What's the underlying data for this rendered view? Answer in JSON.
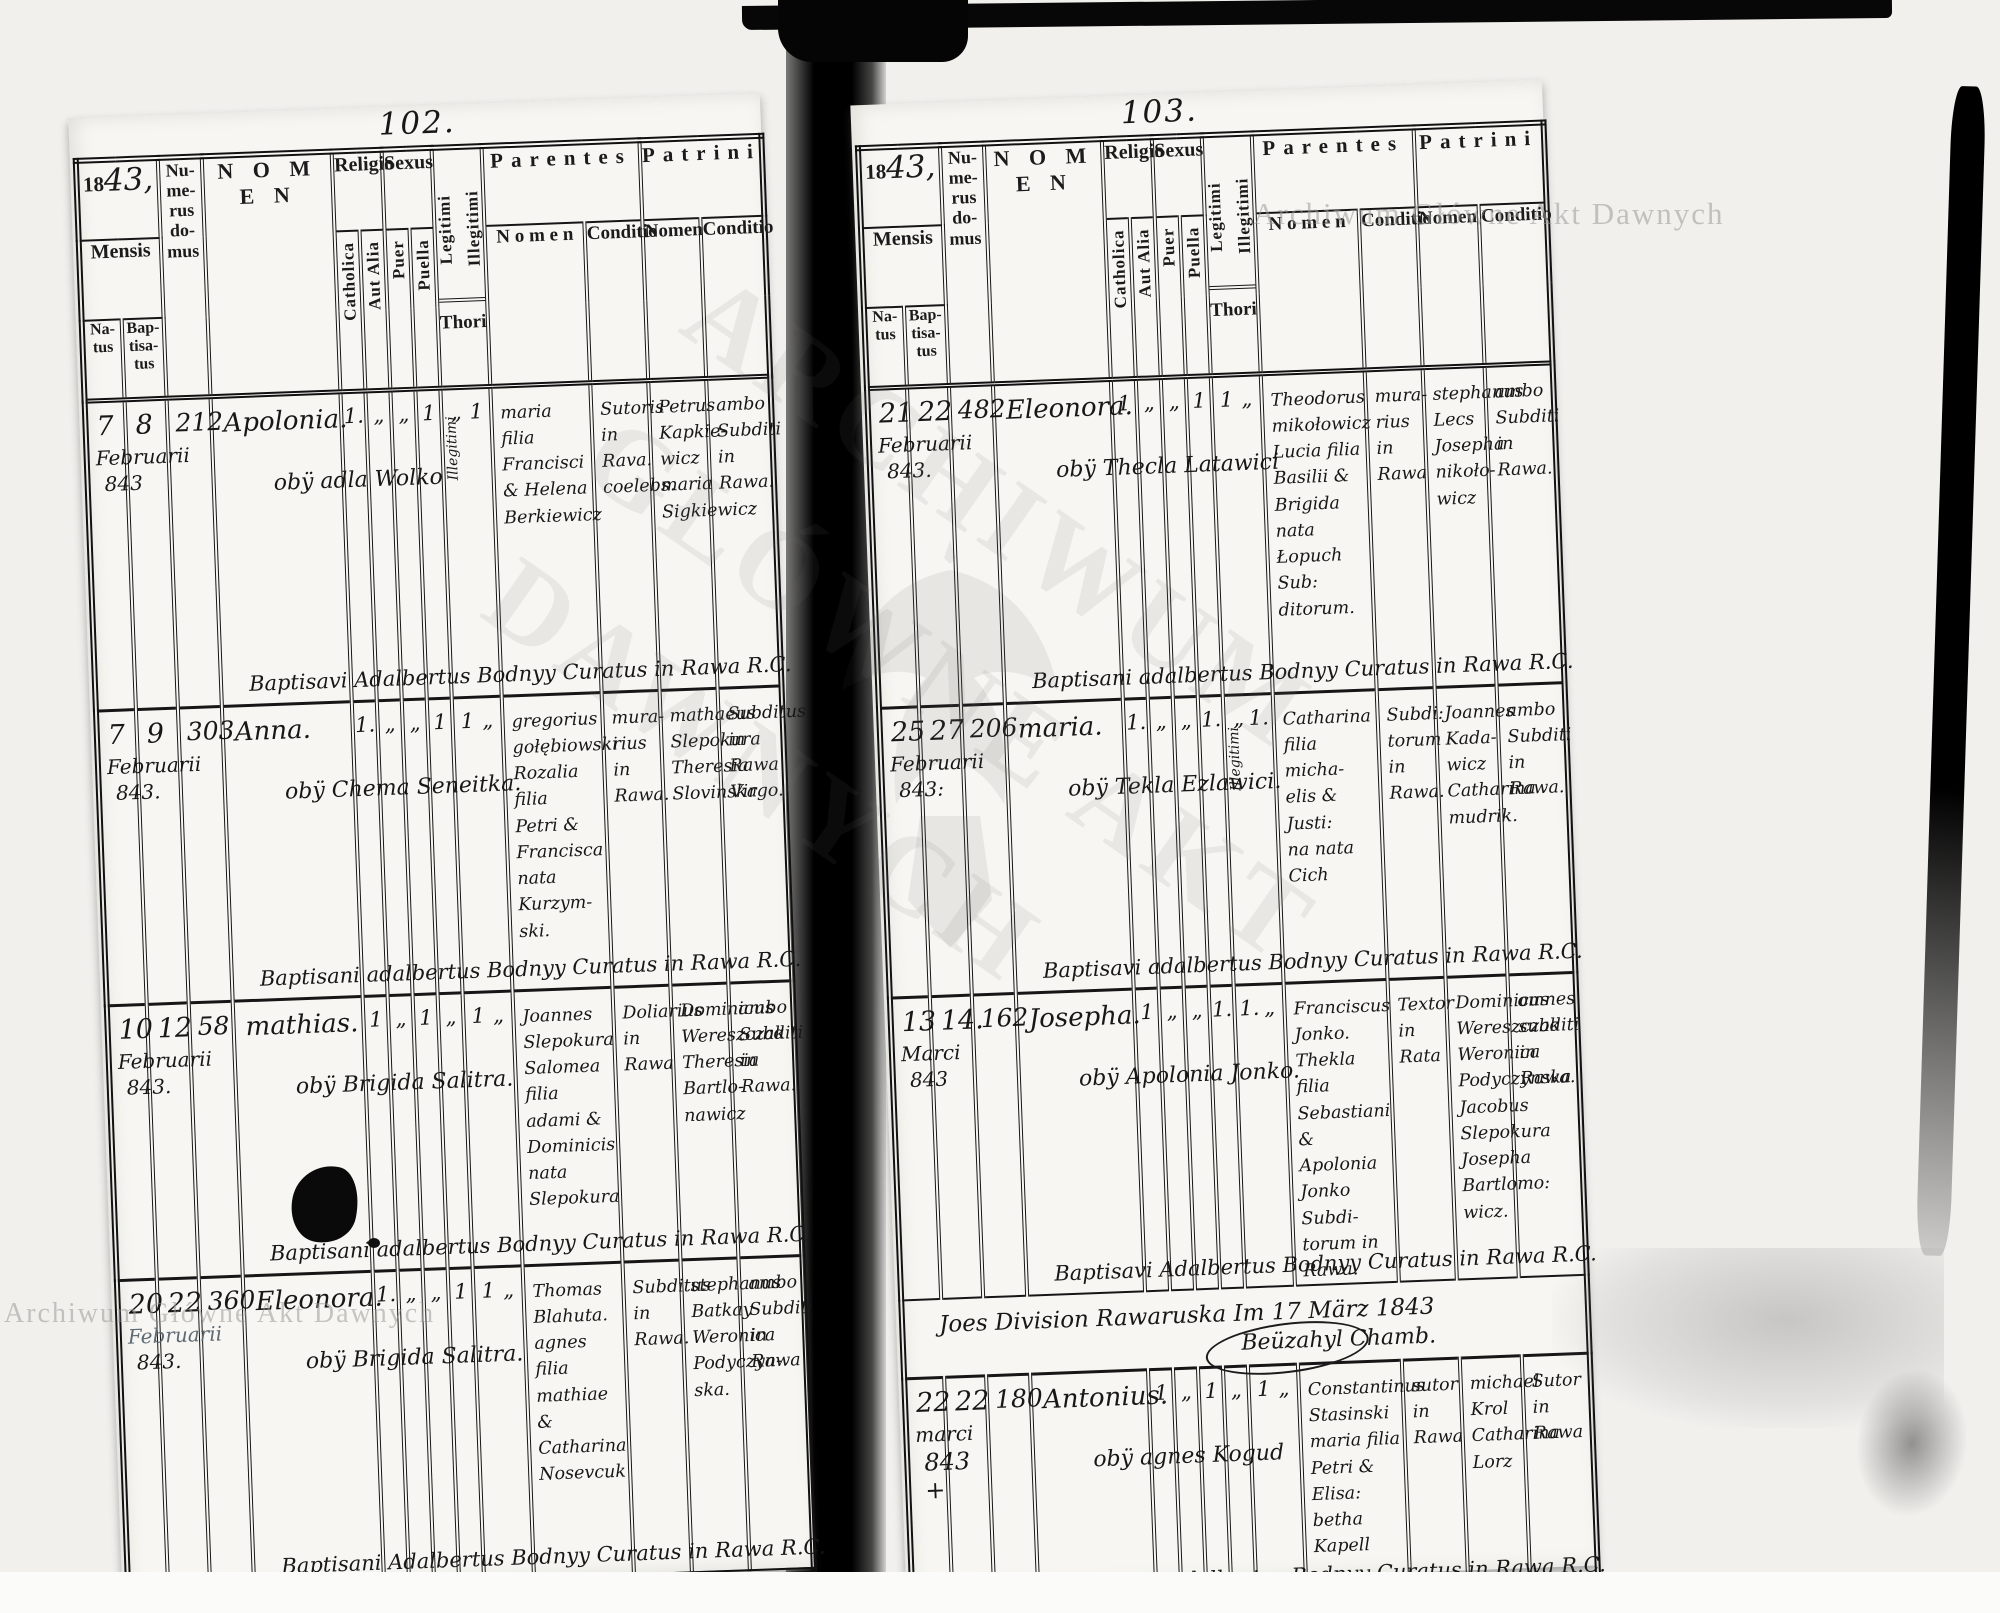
{
  "header": {
    "year_prefix": "18",
    "year_script": "43,",
    "mensis": "Mensis",
    "natus": "Na-\ntus",
    "baptisatus": "Bap-\ntisa-\ntus",
    "numerus": "Nu-\nme-\nrus\ndo-\nmus",
    "nomen": "N O M E N",
    "religio": "Religio",
    "catholica": "Catholica",
    "aut_alia": "Aut Alia",
    "sexus": "Sexus",
    "puer": "Puer",
    "puella": "Puella",
    "legitimi": "Legitimi",
    "illegitimi": "Illegitimi",
    "thori": "Thori",
    "parentes": "Parentes",
    "patrini": "Patrini",
    "parentes_nomen": "N o m e n",
    "parentes_conditio": "Conditio",
    "patrini_nomen": "Nomen",
    "patrini_conditio": "Conditio"
  },
  "watermark": {
    "text": "Archiwum Główne Akt Dawnych",
    "big": "ARCHIWUM\nGŁÓWNE AKT\nDAWNYCH"
  },
  "left_page": {
    "page_number": "102.",
    "entries": [
      {
        "natus_day": "7",
        "baptisatus_day": "8",
        "month": "Februarii",
        "year": "843",
        "house": "212",
        "name": "Apolonia.",
        "name_note": "obÿ adla Wolko",
        "catholica": "1.",
        "aut_alia": "„",
        "puer": "„",
        "puella": "1",
        "legitimi": "„",
        "illegitimi": "1",
        "thori_note": "Illegitimi",
        "parentes_nomen": "maria filia\nFrancisci\n& Helena\nBerkiewicz",
        "parentes_conditio": "Sutoris\nin\nRava.\ncoelebs.",
        "patrini_nomen": "Petrus\nKapkie-\nwicz\nmaria\nSigkiewicz",
        "patrini_conditio": "ambo\nSubditi\nin\nRawa.",
        "baptism_note": "Baptisavi Adalbertus Bodnyy Curatus in Rawa R.C."
      },
      {
        "natus_day": "7",
        "baptisatus_day": "9",
        "month": "Februarii",
        "year": "843.",
        "house": "303",
        "name": "Anna.",
        "name_note": "obÿ Chema Seneitka.",
        "catholica": "1.",
        "aut_alia": "„",
        "puer": "„",
        "puella": "1",
        "legitimi": "1",
        "illegitimi": "„",
        "thori_note": "",
        "parentes_nomen": "gregorius\ngołębiowski\nRozalia filia\nPetri &\nFrancisca\nnata Kurzym-\nski.",
        "parentes_conditio": "mura-\nrius in\nRawa.",
        "patrini_nomen": "mathaeus\nSlepokura\nTheresia\nSlovinska",
        "patrini_conditio": "Subditus\nin\nRawa\nVirgo.",
        "baptism_note": "Baptisani adalbertus Bodnyy Curatus in Rawa R.C."
      },
      {
        "natus_day": "10",
        "baptisatus_day": "12",
        "month": "Februarii",
        "year": "843.",
        "house": "58",
        "name": "mathias.",
        "name_note": "obÿ Brigida Salitra.",
        "catholica": "1",
        "aut_alia": "„",
        "puer": "1",
        "puella": "„",
        "legitimi": "1",
        "illegitimi": "„",
        "thori_note": "",
        "parentes_nomen": "Joannes\nSlepokura\nSalomea filia\nadami &\nDominicis\nnata Slepokura",
        "parentes_conditio": "Doliarius\nin\nRawa",
        "patrini_nomen": "Dominicus\nWereszczak\nTheresia\nBartlo-\nnawicz",
        "patrini_conditio": "ambo\nSubditi\nin\nRawa.",
        "baptism_note": "Baptisani adalbertus Bodnyy Curatus in Rawa R.C."
      },
      {
        "natus_day": "20",
        "baptisatus_day": "22",
        "month": "Februarii",
        "year": "843.",
        "house": "360",
        "name": "Eleonora.",
        "name_note": "obÿ Brigida Salitra.",
        "catholica": "1.",
        "aut_alia": "„",
        "puer": "„",
        "puella": "1",
        "legitimi": "1",
        "illegitimi": "„",
        "thori_note": "",
        "parentes_nomen": "Thomas\nBlahuta.\nagnes filia\nmathiae &\nCatharina\nNosevcuk",
        "parentes_conditio": "Subditus\nin\nRawa.",
        "patrini_nomen": "stephanus\nBatkay\nWeronica\nPodyczyn-\nska.",
        "patrini_conditio": "ambo\nSubditi\nin\nRawa",
        "baptism_note": "Baptisani Adalbertus Bodnyy Curatus in Rawa R.C."
      }
    ]
  },
  "right_page": {
    "page_number": "103.",
    "divider": {
      "text": "Joes Division Rawaruska     Im 17 März 1843",
      "signature": "Beüzahyl Chamb."
    },
    "entries": [
      {
        "natus_day": "21",
        "baptisatus_day": "22",
        "month": "Februarii",
        "year": "843.",
        "house": "482",
        "name": "Eleonora.",
        "name_note": "obÿ Thecla Latawici",
        "catholica": "1",
        "aut_alia": "„",
        "puer": "„",
        "puella": "1",
        "legitimi": "1",
        "illegitimi": "„",
        "thori_note": "",
        "parentes_nomen": "Theodorus\nmikołowicz\nLucia filia\nBasilii &\nBrigida nata\nŁopuch Sub:\nditorum.",
        "parentes_conditio": "mura-\nrius\nin\nRawa",
        "patrini_nomen": "stephanus\nLecs\nJosepha\nnikoło-\nwicz",
        "patrini_conditio": "ambo\nSubditi\nin\nRawa.",
        "baptism_note": "Baptisani adalbertus Bodnyy Curatus in Rawa R.C."
      },
      {
        "natus_day": "25",
        "baptisatus_day": "27",
        "month": "Februarii",
        "year": "843:",
        "house": "206",
        "name": "maria.",
        "name_note": "obÿ Tekla Ezlawici.",
        "catholica": "1.",
        "aut_alia": "„",
        "puer": "„",
        "puella": "1.",
        "legitimi": "„",
        "illegitimi": "1.",
        "thori_note": "Illegitimi.",
        "parentes_nomen": "Catharina\nfilia micha-\nelis & Justi:\nna nata Cich",
        "parentes_conditio": "Subdi:\ntorum\nin\nRawa.",
        "patrini_nomen": "Joannes\nKada-\nwicz\nCatharina\nmudrik.",
        "patrini_conditio": "ambo\nSubditi\nin\nRawa.",
        "baptism_note": "Baptisavi adalbertus Bodnyy Curatus in Rawa R.C."
      },
      {
        "natus_day": "13",
        "baptisatus_day": "14.",
        "month": "Marci",
        "year": "843",
        "house": "162",
        "name": "Josepha.",
        "name_note": "obÿ Apolonia Jonko.",
        "catholica": "1",
        "aut_alia": "„",
        "puer": "„",
        "puella": "1.",
        "legitimi": "1.",
        "illegitimi": "„",
        "thori_note": "",
        "parentes_nomen": "Franciscus\nJonko.\nThekla filia\nSebastiani &\nApolonia\nJonko Subdi-\ntorum in\nRawa.",
        "parentes_conditio": "Textor\nin\nRata",
        "patrini_nomen": "Dominicus\nWereszczak\nWeronica\nPodyczynska\nJacobus\nSlepokura\nJosepha\nBartlomo:\nwicz.",
        "patrini_conditio": "omnes\nsubditi\nin\nRawa.",
        "baptism_note": "Baptisavi Adalbertus Bodnyy Curatus in Rawa R.C."
      },
      {
        "natus_day": "22",
        "baptisatus_day": "22",
        "month": "marci",
        "year": "843\n+",
        "house": "180",
        "name": "Antonius.",
        "name_note": "obÿ agnes Kogud",
        "catholica": "1",
        "aut_alia": "„",
        "puer": "1",
        "puella": "„",
        "legitimi": "1",
        "illegitimi": "„",
        "thori_note": "",
        "parentes_nomen": "Constantinus\nStasinski\nmaria filia\nPetri & Elisa:\nbetha Kapell",
        "parentes_conditio": "sutor\nin\nRawa",
        "patrini_nomen": "michael\nKrol\nCatharina\nLorz",
        "patrini_conditio": "Sutor\nin Rawa",
        "baptism_note": "Baptisavi adalbertus Bodnyy Curatus in Rawa R.C."
      }
    ]
  }
}
